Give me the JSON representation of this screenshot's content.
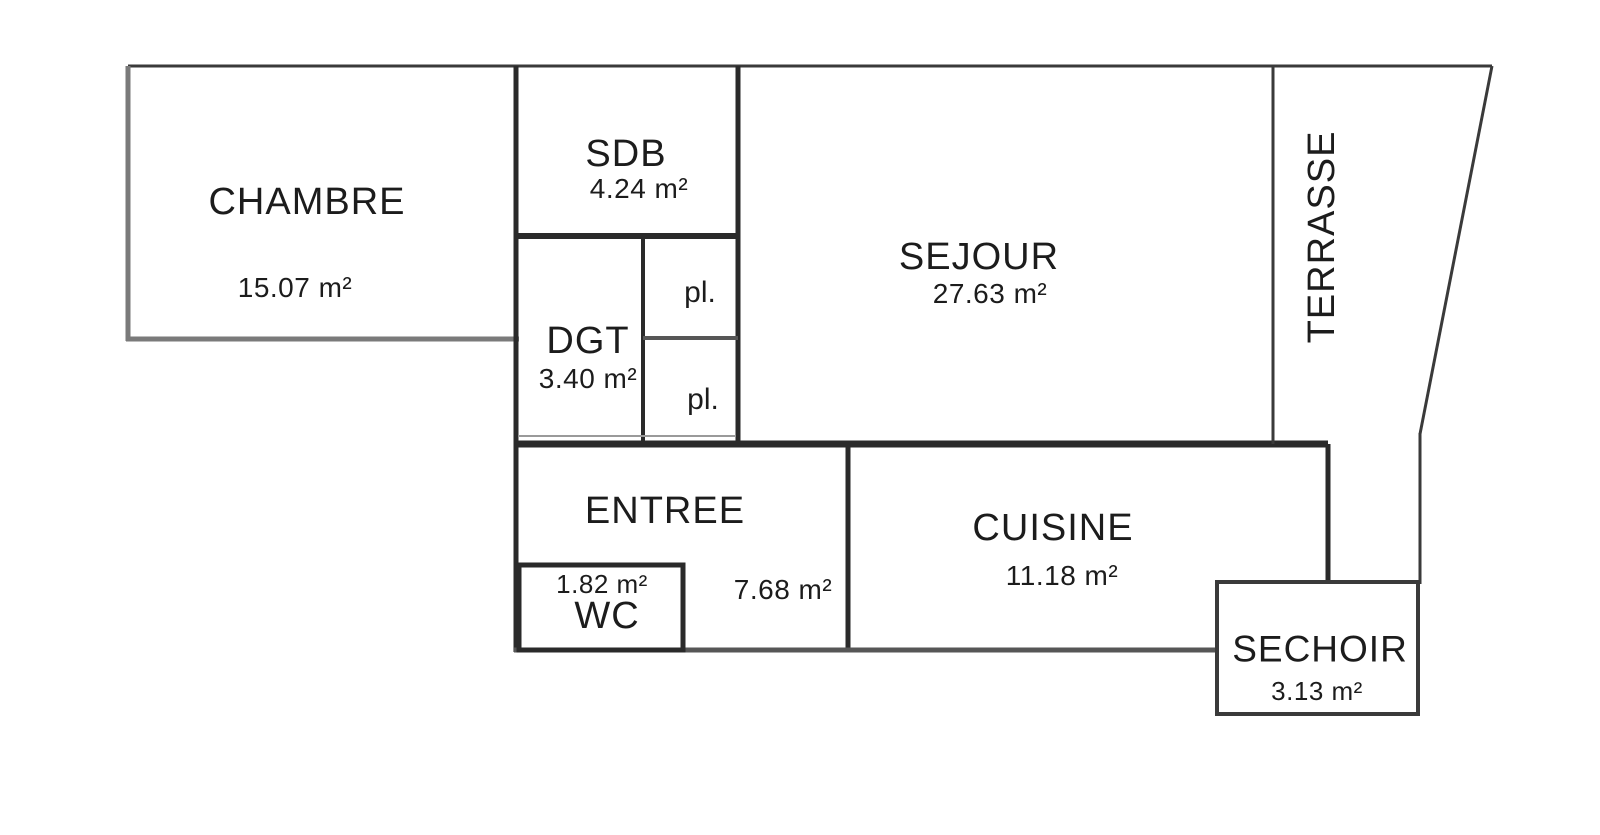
{
  "floorplan": {
    "rooms": {
      "chambre": {
        "label": "CHAMBRE",
        "area": "15.07 m²"
      },
      "sdb": {
        "label": "SDB",
        "area": "4.24 m²"
      },
      "sejour": {
        "label": "SEJOUR",
        "area": "27.63 m²"
      },
      "terrasse": {
        "label": "TERRASSE"
      },
      "dgt": {
        "label": "DGT",
        "area": "3.40 m²"
      },
      "placard_top": {
        "label": "pl."
      },
      "placard_bottom": {
        "label": "pl."
      },
      "entree": {
        "label": "ENTREE",
        "area": "7.68 m²"
      },
      "wc": {
        "label": "WC",
        "area": "1.82 m²"
      },
      "cuisine": {
        "label": "CUISINE",
        "area": "11.18 m²"
      },
      "sechoir": {
        "label": "SECHOIR",
        "area": "3.13 m²"
      }
    },
    "colors": {
      "wall": "#2a2a2a",
      "wall_light": "#7a7a7a",
      "text": "#1c1c1c",
      "background": "#ffffff"
    }
  }
}
